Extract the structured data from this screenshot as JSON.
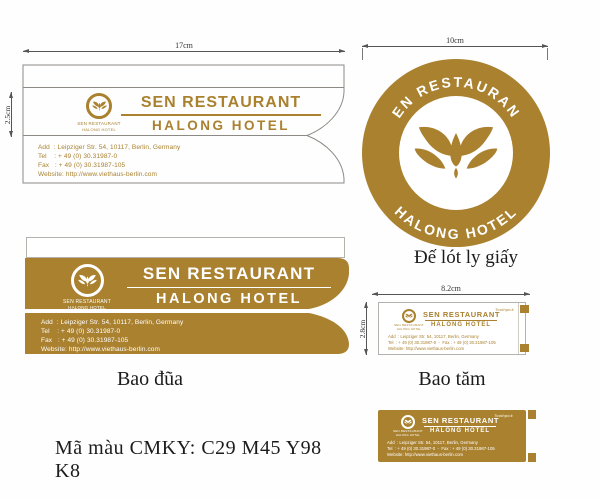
{
  "colors": {
    "gold": "#a9812f",
    "line": "#555555",
    "label": "#1c1c1c"
  },
  "brand": {
    "name": "SEN RESTAURANT",
    "sub": "HALONG HOTEL",
    "address": "Add  : Leipziger Str. 54, 10117, Berlin, Germany",
    "tel": "Tel    : + 49 (0) 30.31987-0",
    "fax": "Fax   : + 49 (0) 30.31987-105",
    "website": "Website: http://www.viethaus-berlin.com",
    "tel_fax": "Tel  : + 49 (0) 30.31987-0  -  Fax : + 49 (0) 30.31987-105",
    "toothpick_note": "Toothpick"
  },
  "dims": {
    "chopstick_width": "17cm",
    "chopstick_band_height": "2.5cm",
    "coaster_diameter": "10cm",
    "toothpick_width": "8.2cm",
    "toothpick_height": "2.8cm"
  },
  "captions": {
    "chopstick": "Bao đũa",
    "coaster": "Đế lót ly giấy",
    "toothpick": "Bao tăm",
    "cmyk": "Mã màu CMKY: C29 M45 Y98 K8"
  }
}
